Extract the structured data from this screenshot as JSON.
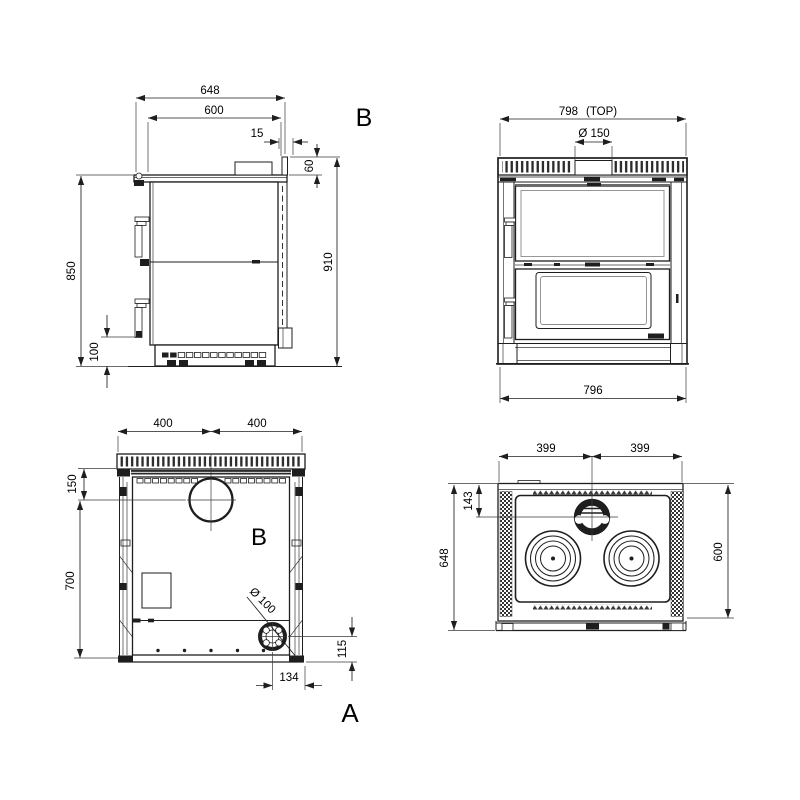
{
  "colors": {
    "line": "#1e1e1e",
    "text": "#000000",
    "background": "#ffffff"
  },
  "labels": {
    "section_b": "B",
    "rear_b": "B",
    "rear_a": "A"
  },
  "side_view": {
    "dims": {
      "overall_width": "648",
      "top_width": "600",
      "flue_offset": "15",
      "collar_height": "60",
      "body_height": "850",
      "overall_height": "910",
      "base_height": "100"
    }
  },
  "front_view": {
    "dims": {
      "top_width": "798",
      "top_width_note": "(TOP)",
      "flue_diameter": "Ø 150",
      "base_width": "796"
    }
  },
  "rear_view": {
    "dims": {
      "left_half": "400",
      "right_half": "400",
      "flue_drop": "150",
      "panel_height": "700",
      "outlet_diameter": "Ø 100",
      "outlet_bottom_offset": "115",
      "outlet_side_offset": "134"
    }
  },
  "top_view": {
    "dims": {
      "left_half": "399",
      "right_half": "399",
      "flue_center_offset": "143",
      "depth": "648",
      "plate_depth": "600"
    }
  }
}
